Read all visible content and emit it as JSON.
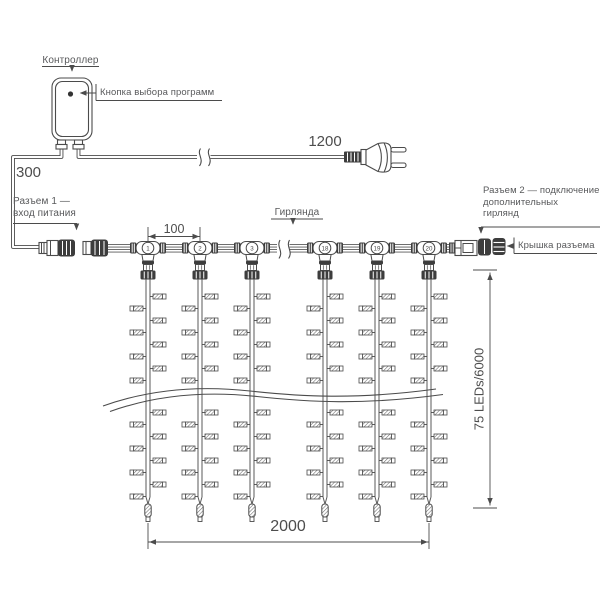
{
  "labels": {
    "controller": "Контроллер",
    "program_button": "Кнопка выбора программ",
    "connector1_line1": "Разъем 1 —",
    "connector1_line2": "вход питания",
    "connector2_line1": "Разъем 2 — подключение",
    "connector2_line2": "дополнительных",
    "connector2_line3": "гирлянд",
    "connector_cap": "Крышка разъема",
    "garland": "Гирлянда"
  },
  "dimensions": {
    "controller_to_connector1": "300",
    "cable_to_plug": "1200",
    "drop_spacing": "100",
    "curtain_width": "2000",
    "curtain_height": "75 LEDs/6000"
  },
  "curtain": {
    "drops": [
      {
        "number": "1",
        "x": 148
      },
      {
        "number": "2",
        "x": 200
      },
      {
        "number": "3",
        "x": 252
      },
      {
        "number": "18",
        "x": 325
      },
      {
        "number": "19",
        "x": 377
      },
      {
        "number": "20",
        "x": 429
      }
    ],
    "led_y_right": [
      294,
      318,
      342,
      366,
      410,
      434,
      458,
      482
    ],
    "led_y_left": [
      306,
      330,
      354,
      378,
      422,
      446,
      470,
      494
    ],
    "string_top": 279.5,
    "string_bottom": 497
  },
  "colors": {
    "line": "#4b4b4b",
    "text": "#58595b",
    "dark_fill": "#3d3d3d",
    "background": "#ffffff"
  }
}
